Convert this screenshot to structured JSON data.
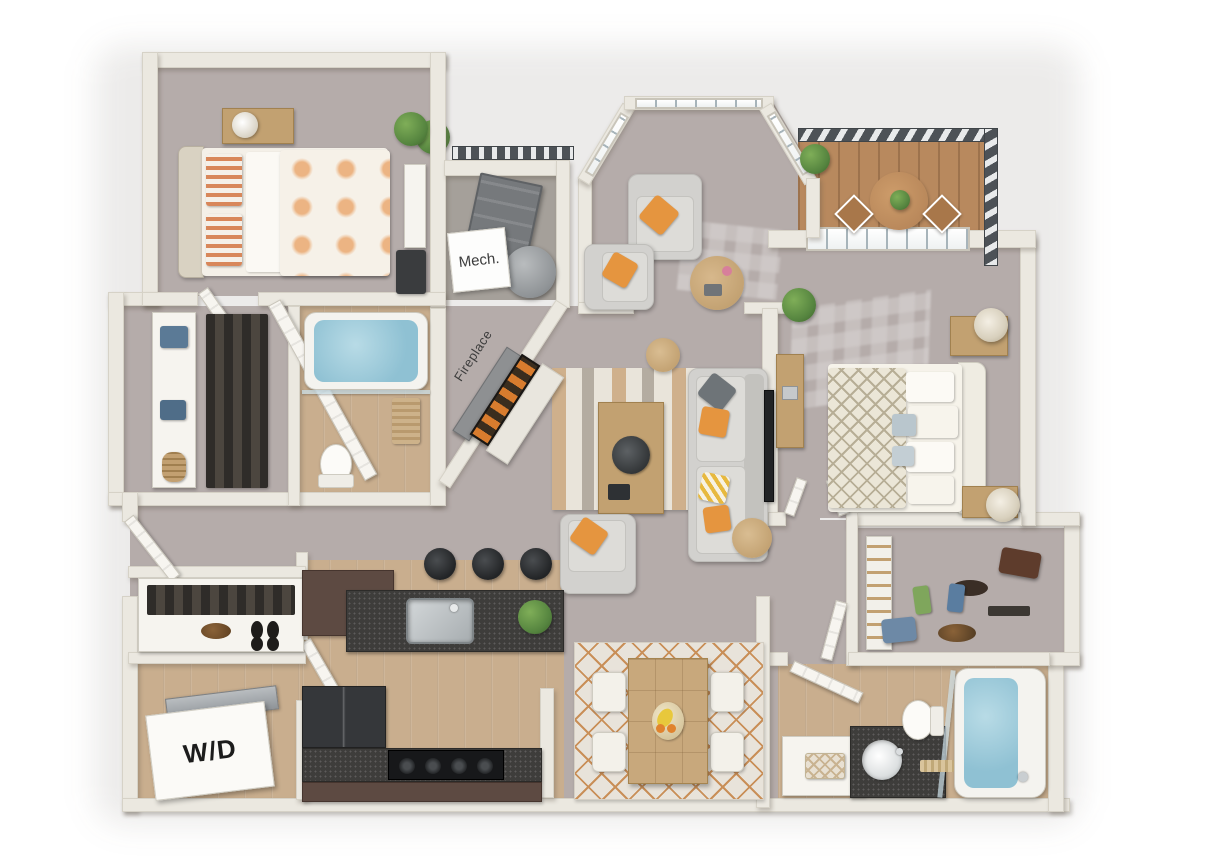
{
  "labels": {
    "mech": "Mech.",
    "fireplace": "Fireplace",
    "washer_dryer": "W/D"
  },
  "colors": {
    "bg": "#ffffff",
    "wall": "#ebe8e0",
    "carpet": "#b5acaa",
    "wood": "#c9ae8e",
    "deck": "#b8895e",
    "railing": "#4d5257",
    "sofa": "#d2d1ce",
    "accent": "#e5953f",
    "rug-tan": "#c99a66",
    "counter": "#3e3d3b",
    "cabinet": "#5d4a42",
    "steel": "#b9bec1",
    "water": "#8fc1d3",
    "plant": "#55843f",
    "wood-furn": "#c2a171",
    "dark-appliance": "#35373a",
    "label-ink": "#3c3c3c"
  }
}
